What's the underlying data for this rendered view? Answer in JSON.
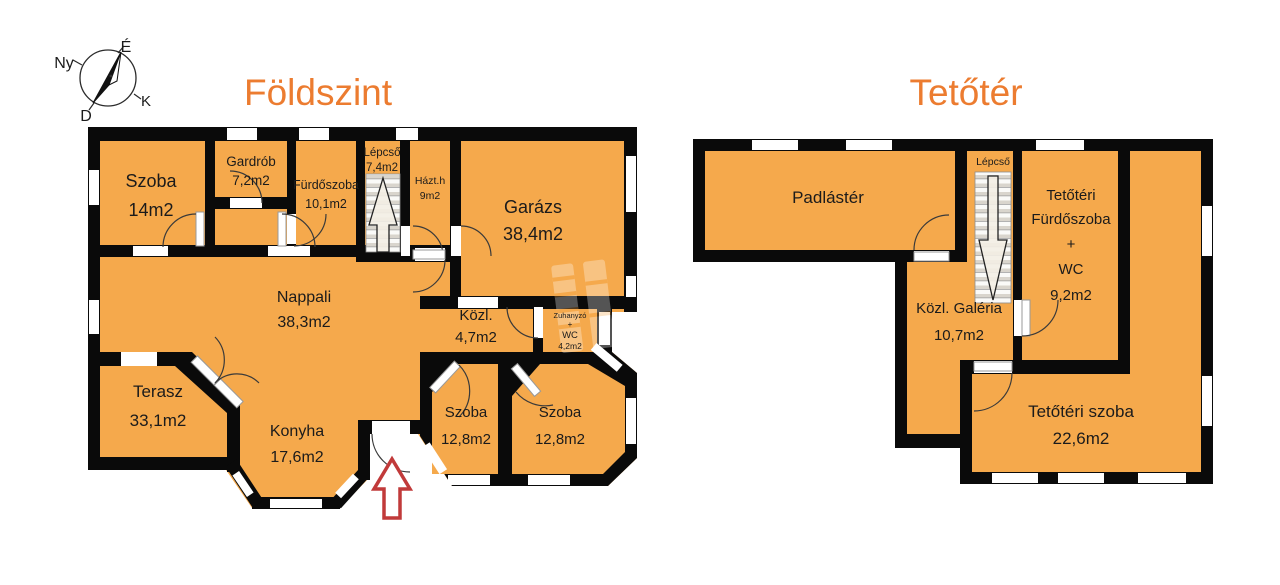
{
  "compass": {
    "north": "É",
    "west": "Ny",
    "east": "K",
    "south": "D"
  },
  "floors": {
    "ground": {
      "title": "Földszint",
      "rooms": {
        "szoba1": {
          "name": "Szoba",
          "area": "14m2"
        },
        "gardrob": {
          "name": "Gardrób",
          "area": "7,2m2"
        },
        "furdoszoba": {
          "name": "Fürdőszoba",
          "area": "10,1m2"
        },
        "lepcso": {
          "name": "Lépcső",
          "area": "7,4m2"
        },
        "haztartasi": {
          "name": "Házt.h",
          "area": "9m2"
        },
        "garazs": {
          "name": "Garázs",
          "area": "38,4m2"
        },
        "nappali": {
          "name": "Nappali",
          "area": "38,3m2"
        },
        "kozlekedo": {
          "name": "Közl.",
          "area": "4,7m2"
        },
        "zuhanyzo": {
          "name": "Zuhanyzó",
          "plus": "+",
          "wc": "WC",
          "area": "4,2m2"
        },
        "terasz": {
          "name": "Terasz",
          "area": "33,1m2"
        },
        "konyha": {
          "name": "Konyha",
          "area": "17,6m2"
        },
        "szoba2": {
          "name": "Szoba",
          "area": "12,8m2"
        },
        "szoba3": {
          "name": "Szoba",
          "area": "12,8m2"
        }
      }
    },
    "attic": {
      "title": "Tetőtér",
      "rooms": {
        "padlaster": {
          "name": "Padlástér"
        },
        "lepcso": {
          "name": "Lépcső"
        },
        "furdoszoba": {
          "line1": "Tetőtéri",
          "line2": "Fürdőszoba",
          "plus": "+",
          "wc": "WC",
          "area": "9,2m2"
        },
        "galeria": {
          "name": "Közl. Galéria",
          "area": "10,7m2"
        },
        "szoba": {
          "name": "Tetőtéri szoba",
          "area": "22,6m2"
        }
      }
    }
  },
  "colors": {
    "room_fill": "#F5A94C",
    "wall": "#0A0A0A",
    "title": "#EC7C30",
    "entrance_arrow": "#C13A3A"
  }
}
